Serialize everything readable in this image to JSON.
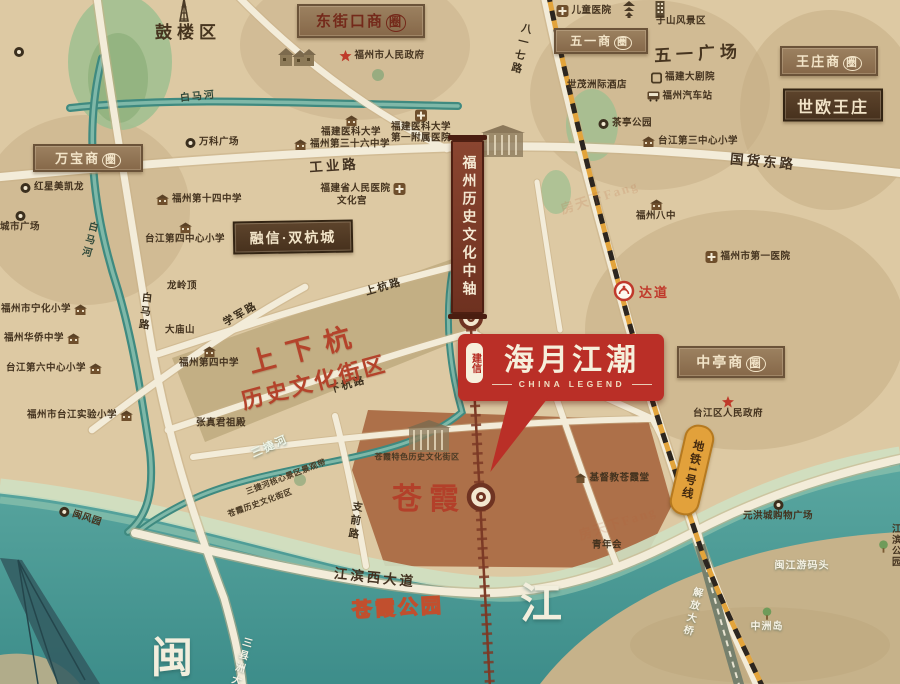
{
  "branding": {
    "seal": "建信",
    "title": "海月江潮",
    "subtitle": "CHINA LEGEND"
  },
  "banner": {
    "text": "福州历史文化中轴"
  },
  "metro": {
    "line_label": "地铁1号线",
    "station_label": "达道"
  },
  "heritage": {
    "line1": "上下杭",
    "line2": "历史文化街区"
  },
  "map": {
    "boxes": [
      {
        "n": "box-dongjiekou-cbd",
        "label": "东街口商圈",
        "x": 361,
        "y": 21,
        "w": 124,
        "h": 30,
        "cls": "maroon",
        "circ": 1,
        "fs": 15
      },
      {
        "n": "box-wanbao-cbd",
        "label": "万宝商圈",
        "x": 88,
        "y": 158,
        "w": 106,
        "h": 24,
        "cls": "",
        "circ": 1,
        "fs": 13
      },
      {
        "n": "box-wuyi-cbd",
        "label": "五一商圈",
        "x": 601,
        "y": 41,
        "w": 90,
        "h": 22,
        "cls": "",
        "circ": 1,
        "fs": 12
      },
      {
        "n": "box-wangzhuang-cbd",
        "label": "王庄商圈",
        "x": 829,
        "y": 61,
        "w": 94,
        "h": 26,
        "cls": "",
        "circ": 1,
        "fs": 13
      },
      {
        "n": "box-zhongting-cbd",
        "label": "中亭商圈",
        "x": 731,
        "y": 362,
        "w": 104,
        "h": 28,
        "cls": "",
        "circ": 1,
        "fs": 14
      },
      {
        "n": "box-shiou-wangzhuang",
        "label": "世欧王庄",
        "x": 833,
        "y": 105,
        "w": 96,
        "h": 29,
        "cls": "dark",
        "fs": 16
      },
      {
        "n": "box-rongxin-shuanghangcheng",
        "label": "融信·双杭城",
        "x": 293,
        "y": 237,
        "w": 116,
        "h": 29,
        "cls": "dark",
        "fs": 14,
        "r": -1
      }
    ],
    "items": [
      {
        "n": "gulou-tower-icon",
        "x": 184,
        "y": 11,
        "ic": "tower"
      },
      {
        "n": "pagoda-icon",
        "x": 629,
        "y": 9,
        "ic": "pagoda"
      },
      {
        "n": "yushan-building-icon",
        "x": 660,
        "y": 9,
        "ic": "bldg"
      },
      {
        "n": "houses-icon",
        "x": 297,
        "y": 57,
        "ic": "houses"
      },
      {
        "n": "sketch-building-icon",
        "x": 503,
        "y": 141,
        "ic": "sketch"
      },
      {
        "n": "cangxia-building-icon",
        "x": 429,
        "y": 436,
        "ic": "sketch"
      },
      {
        "n": "park-poi-icon",
        "x": 19,
        "y": 52,
        "ic": "poi"
      },
      {
        "n": "children-hospital",
        "t": "儿童医院",
        "x": 584,
        "y": 11,
        "ic": "hosp"
      },
      {
        "n": "yushan-scenic-area",
        "t": "于山风景区",
        "x": 681,
        "y": 22
      },
      {
        "n": "city-government",
        "t": "福州市人民政府",
        "x": 382,
        "y": 56,
        "ic": "star"
      },
      {
        "n": "shimao-hotel",
        "t": "世茂洲际酒店",
        "x": 597,
        "y": 86
      },
      {
        "n": "fujian-grand-theatre",
        "t": "福建大剧院",
        "x": 683,
        "y": 78,
        "ic": "sq"
      },
      {
        "n": "fuzhou-bus-station",
        "t": "福州汽车站",
        "x": 680,
        "y": 97,
        "ic": "bus"
      },
      {
        "n": "chating-park",
        "t": "茶亭公园",
        "x": 625,
        "y": 124,
        "ic": "poi"
      },
      {
        "n": "taijiang-no3-primary",
        "t": "台江第三中心小学",
        "x": 690,
        "y": 142,
        "ic": "sch"
      },
      {
        "n": "fuzhou-no8-school",
        "t": "福州八中",
        "x": 656,
        "y": 211,
        "ic": "sch",
        "ip": "t"
      },
      {
        "n": "fujian-medical-university",
        "t": "福建医科大学",
        "x": 351,
        "y": 127,
        "ic": "sch",
        "ip": "t"
      },
      {
        "n": "fjmu-first-hospital",
        "t": "福建医科大学\n第一附属医院",
        "x": 421,
        "y": 127,
        "ic": "hosp",
        "ip": "t"
      },
      {
        "n": "fuzhou-no36-school",
        "t": "福州第三十六中学",
        "x": 342,
        "y": 145,
        "ic": "sch"
      },
      {
        "n": "wanke-plaza",
        "t": "万科广场",
        "x": 212,
        "y": 143,
        "ic": "poi"
      },
      {
        "n": "province-people-hospital",
        "t": "福建省人民医院",
        "x": 363,
        "y": 189,
        "ic": "hosp",
        "ip": "r"
      },
      {
        "n": "culture-palace",
        "t": "文化宫",
        "x": 352,
        "y": 202
      },
      {
        "n": "hongxing-meikailong",
        "t": "红星美凯龙",
        "x": 52,
        "y": 188,
        "ic": "poi"
      },
      {
        "n": "city-plaza",
        "t": "城市广场",
        "x": 20,
        "y": 222,
        "ic": "poi",
        "ip": "t"
      },
      {
        "n": "fuzhou-no14-school",
        "t": "福州第十四中学",
        "x": 199,
        "y": 200,
        "ic": "sch"
      },
      {
        "n": "taijiang-no4-primary",
        "t": "台江第四中心小学",
        "x": 185,
        "y": 234,
        "ic": "sch",
        "ip": "t"
      },
      {
        "n": "longlingding",
        "t": "龙岭顶",
        "x": 182,
        "y": 287
      },
      {
        "n": "damiaoshan",
        "t": "大庙山",
        "x": 180,
        "y": 331
      },
      {
        "n": "fuzhou-no4-school",
        "t": "福州第四中学",
        "x": 209,
        "y": 358,
        "ic": "sch",
        "ip": "t"
      },
      {
        "n": "ninghua-primary",
        "t": "福州市宁化小学",
        "x": 44,
        "y": 310,
        "ic": "sch",
        "ip": "r"
      },
      {
        "n": "huaqiao-school",
        "t": "福州华侨中学",
        "x": 42,
        "y": 339,
        "ic": "sch",
        "ip": "r"
      },
      {
        "n": "taijiang-no6-primary",
        "t": "台江第六中心小学",
        "x": 54,
        "y": 369,
        "ic": "sch",
        "ip": "r"
      },
      {
        "n": "taijiang-shiyan-primary",
        "t": "福州市台江实验小学",
        "x": 80,
        "y": 416,
        "ic": "sch",
        "ip": "r"
      },
      {
        "n": "zhangzhenjun-temple",
        "t": "张真君祖殿",
        "x": 221,
        "y": 424
      },
      {
        "n": "qingnianhui",
        "t": "青年会",
        "x": 607,
        "y": 546
      },
      {
        "n": "cangxia-church",
        "t": "基督教苍霞堂",
        "x": 612,
        "y": 479,
        "ic": "house"
      },
      {
        "n": "yuanhong-mall",
        "t": "元洪城购物广场",
        "x": 778,
        "y": 511,
        "ic": "poi",
        "ip": "t"
      },
      {
        "n": "zhongzhou-island",
        "t": "中洲岛",
        "x": 767,
        "y": 620,
        "cls": "w",
        "ic": "tree",
        "ip": "t"
      },
      {
        "n": "minjiang-wharf",
        "t": "闽江游码头",
        "x": 802,
        "y": 566,
        "cls": "w"
      },
      {
        "n": "jiangbin-park",
        "t": "江滨公园",
        "x": 890,
        "y": 547,
        "ic": "tree"
      },
      {
        "n": "minfeng-park",
        "t": "闽风园",
        "x": 80,
        "y": 517,
        "ic": "poi",
        "r": 18
      },
      {
        "n": "taijiang-government",
        "t": "台江区人民政府",
        "x": 728,
        "y": 408,
        "ic": "star",
        "ip": "t"
      },
      {
        "n": "fuzhou-no1-hospital",
        "t": "福州市第一医院",
        "x": 748,
        "y": 257,
        "ic": "hosp"
      },
      {
        "n": "cangxia-heritage-area",
        "t": "苍霞特色历史文化街区",
        "x": 417,
        "y": 457,
        "cls": "xs"
      },
      {
        "n": "jiefang-bridge-label",
        "t": "解放大桥",
        "x": 691,
        "y": 612,
        "cls": "w",
        "v": 1,
        "r": 14
      },
      {
        "n": "sanxianzhou-bridge-label",
        "t": "三县洲大桥",
        "x": 238,
        "y": 668,
        "cls": "w",
        "v": 1,
        "r": 16
      },
      {
        "n": "road-gongye",
        "t": "工业路",
        "x": 334,
        "y": 166,
        "cls": "rdb",
        "r": -4
      },
      {
        "n": "road-guohuodong",
        "t": "国货东路",
        "x": 763,
        "y": 162,
        "cls": "rdb",
        "r": 5
      },
      {
        "n": "road-jiangbinxi",
        "t": "江滨西大道",
        "x": 375,
        "y": 578,
        "cls": "rdb",
        "r": 6
      },
      {
        "n": "road-bayiqi",
        "t": "八一七路",
        "x": 520,
        "y": 49,
        "cls": "rd",
        "v": 1,
        "r": 14
      },
      {
        "n": "road-baima",
        "t": "白马路",
        "x": 144,
        "y": 312,
        "cls": "rd",
        "v": 1,
        "r": 6
      },
      {
        "n": "road-shanghang",
        "t": "上杭路",
        "x": 384,
        "y": 288,
        "cls": "rd",
        "r": -16
      },
      {
        "n": "road-xiahang",
        "t": "下杭路",
        "x": 348,
        "y": 386,
        "cls": "rd",
        "r": -16
      },
      {
        "n": "road-xuejun",
        "t": "学军路",
        "x": 241,
        "y": 315,
        "cls": "rd",
        "r": -30
      },
      {
        "n": "road-zhiqian",
        "t": "支前路",
        "x": 354,
        "y": 521,
        "cls": "rd",
        "v": 1,
        "r": 8
      },
      {
        "n": "river-baimahe-label-1",
        "t": "白马河",
        "x": 198,
        "y": 97,
        "cls": "rv",
        "r": -6
      },
      {
        "n": "river-baimahe-label-2",
        "t": "白马河",
        "x": 88,
        "y": 240,
        "cls": "rv",
        "v": 1,
        "r": 14
      },
      {
        "n": "river-sanjiehe-label",
        "t": "三捷河",
        "x": 270,
        "y": 447,
        "cls": "rvw",
        "r": -24
      },
      {
        "n": "sanjiehe-scenic-belt",
        "t": "三捷河核心景区景观带",
        "x": 286,
        "y": 477,
        "cls": "xs",
        "r": -21
      },
      {
        "n": "cangxia-history-belt",
        "t": "苍霞历史文化街区",
        "x": 260,
        "y": 503,
        "cls": "xs",
        "r": -20
      },
      {
        "n": "gulou-district-label",
        "t": "鼓楼区",
        "x": 188,
        "y": 33,
        "cls": "big1"
      },
      {
        "n": "wuyi-square-label",
        "t": "五一广场",
        "x": 698,
        "y": 54,
        "cls": "big1",
        "r": -3
      },
      {
        "n": "cangxia-label",
        "t": "苍霞",
        "x": 429,
        "y": 500,
        "cls": "redbig"
      },
      {
        "n": "cangxia-park-label",
        "t": "苍霞公园",
        "x": 398,
        "y": 609,
        "cls": "redol",
        "r": -3
      },
      {
        "n": "minjiang-char-min",
        "t": "闽",
        "x": 172,
        "y": 659,
        "cls": "riverbig"
      },
      {
        "n": "minjiang-char-jiang",
        "t": "江",
        "x": 541,
        "y": 605,
        "cls": "riverbig"
      },
      {
        "n": "watermark-1",
        "t": "房天下Fang",
        "x": 600,
        "y": 198,
        "cls": "wm",
        "r": -18
      },
      {
        "n": "watermark-2",
        "t": "房天下Fang",
        "x": 618,
        "y": 524,
        "cls": "wm",
        "r": -18
      }
    ]
  }
}
